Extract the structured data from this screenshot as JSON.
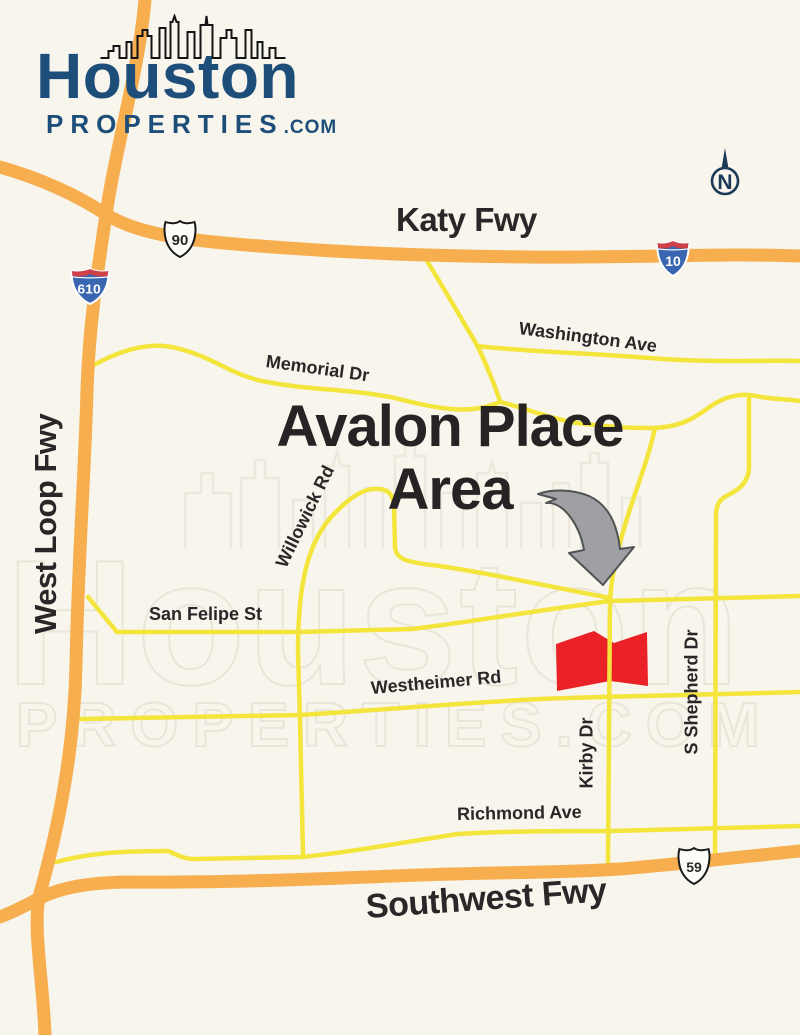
{
  "logo": {
    "brand": "Houston",
    "properties": "PROPERTIES",
    "tld": ".COM"
  },
  "compass": {
    "label": "N"
  },
  "title": {
    "line1": "Avalon Place",
    "line2": "Area"
  },
  "watermark": {
    "line1": "Houston",
    "line2": "PROPERTIES.COM"
  },
  "labels": {
    "katy_fwy": "Katy Fwy",
    "west_loop_fwy": "West Loop Fwy",
    "southwest_fwy": "Southwest Fwy",
    "washington_ave": "Washington Ave",
    "memorial_dr": "Memorial Dr",
    "willowick_rd": "Willowick Rd",
    "san_felipe_st": "San Felipe St",
    "westheimer_rd": "Westheimer Rd",
    "kirby_dr": "Kirby Dr",
    "s_shepherd_dr": "S Shepherd Dr",
    "richmond_ave": "Richmond Ave"
  },
  "shields": {
    "us90": "90",
    "i10": "10",
    "i610": "610",
    "us59": "59"
  },
  "colors": {
    "freeway": "#F6AE4F",
    "street": "#F3E53B",
    "area_fill": "#EA2127",
    "arrow_fill": "#9EA0A3",
    "brand_blue": "#1D4E7A",
    "compass_navy": "#1B3A57",
    "ink": "#2B2728"
  }
}
